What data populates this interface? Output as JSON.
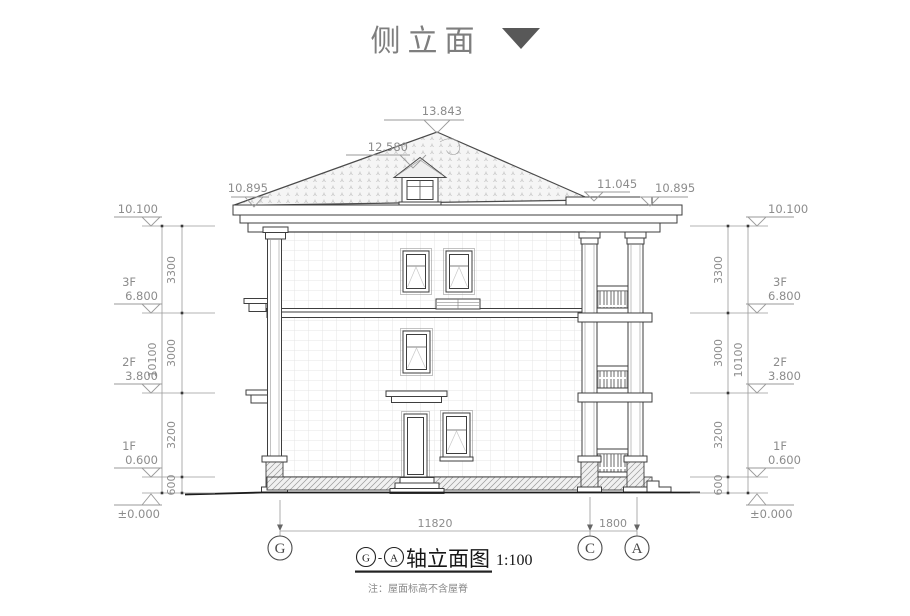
{
  "page": {
    "title": "侧立面"
  },
  "markers": {
    "ridge": "13.843",
    "dormer_ridge": "12.580",
    "left_eave": "10.895",
    "porch_top": "11.045",
    "right_eave": "10.895"
  },
  "levels": [
    {
      "label": "",
      "value": "10.100"
    },
    {
      "label": "3F",
      "value": "6.800"
    },
    {
      "label": "2F",
      "value": "3.800"
    },
    {
      "label": "1F",
      "value": "0.600"
    },
    {
      "label": "",
      "value": "±0.000"
    }
  ],
  "vertical_dims": {
    "segments": [
      "3300",
      "3000",
      "3200",
      "600"
    ],
    "total": "10100"
  },
  "axis_dims": {
    "main_span": "11820",
    "porch_span": "1800"
  },
  "axes": [
    "G",
    "C",
    "A"
  ],
  "figure": {
    "axis_start": "G",
    "separator": "-",
    "axis_end": "A",
    "name": "轴立面图",
    "scale": "1:100"
  },
  "note": "注：屋面标高不含屋脊"
}
